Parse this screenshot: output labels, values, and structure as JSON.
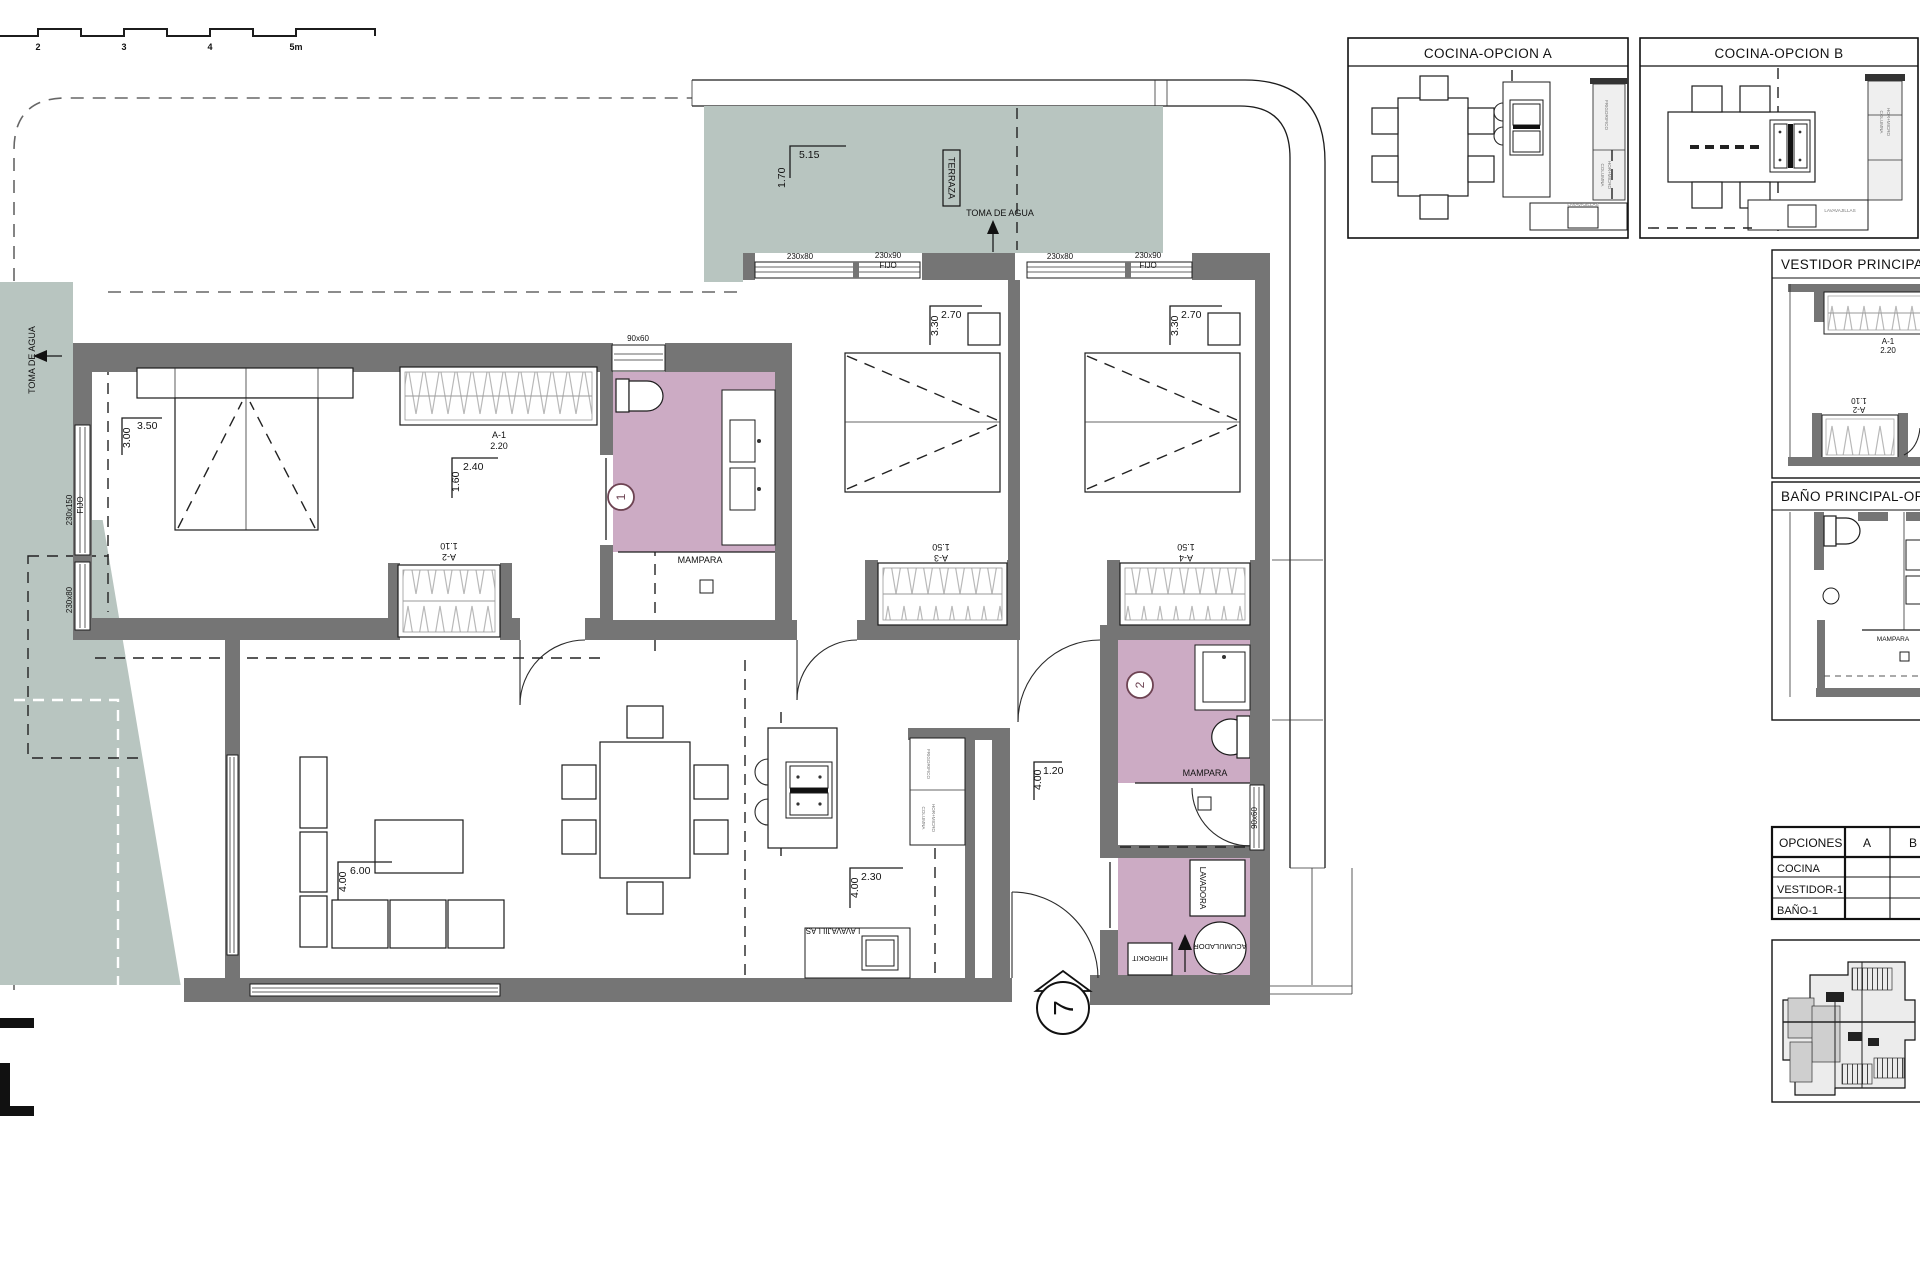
{
  "colors": {
    "wall": "#757575",
    "terrace": "#b8c5c0",
    "wet_room": "#ccabc4",
    "marker": "#6d4352",
    "line": "#1c1c1c"
  },
  "scale_bar": {
    "l2": "2",
    "l3": "3",
    "l4": "4",
    "l5": "5m"
  },
  "plan": {
    "terraza": "TERRAZA",
    "toma_de_agua": "TOMA DE AGUA",
    "mampara": "MAMPARA",
    "dims": {
      "terr_a": "5.15",
      "terr_b": "1.70",
      "master_a": "3.50",
      "master_b": "3.00",
      "vest_a": "2.40",
      "vest_b": "1.60",
      "bed2_a": "2.70",
      "bed2_b": "3.30",
      "bed3_a": "2.70",
      "bed3_b": "3.30",
      "liv_a": "6.00",
      "liv_b": "4.00",
      "kit_a": "2.30",
      "kit_b": "4.00",
      "hall_a": "1.20",
      "hall_b": "4.00"
    },
    "wardrobes": {
      "a1_name": "A-1",
      "a1_size": "2.20",
      "a2_name": "A-2",
      "a2_size": "1.10",
      "a3_name": "A-3",
      "a3_size": "1.50",
      "a4_name": "A-4",
      "a4_size": "1.50"
    },
    "windows": {
      "w1": "230x80",
      "w2": "230x90",
      "fijo": "FIJO",
      "w3": "230x150",
      "w4": "90x60"
    },
    "kitchen": {
      "frigorifico": "FRIGORIFICO",
      "columna": "COLUMNA",
      "hor_micro": "HOR+MICRO",
      "lavavajillas": "LAVAVAJILLAS"
    },
    "laundry": {
      "lavadora": "LAVADORA",
      "acumulador": "ACUMULADOR",
      "hidrokit": "HIDROKIT"
    },
    "markers": {
      "bath1": "1",
      "bath2": "2",
      "unit": "7"
    }
  },
  "panels": {
    "cocina_a": {
      "title": "COCINA-OPCION A"
    },
    "cocina_b": {
      "title": "COCINA-OPCION B"
    },
    "vestidor": {
      "title": "VESTIDOR PRINCIPAL-O",
      "a1_name": "A-1",
      "a1_size": "2.20",
      "a2_name": "A-2",
      "a2_size": "1.10"
    },
    "bano": {
      "title": "BAÑO PRINCIPAL-OPC",
      "mampara": "MAMPARA"
    }
  },
  "options_table": {
    "c1": "OPCIONES",
    "c2": "A",
    "c3": "B",
    "r1": "COCINA",
    "r2": "VESTIDOR-1",
    "r3": "BAÑO-1"
  }
}
